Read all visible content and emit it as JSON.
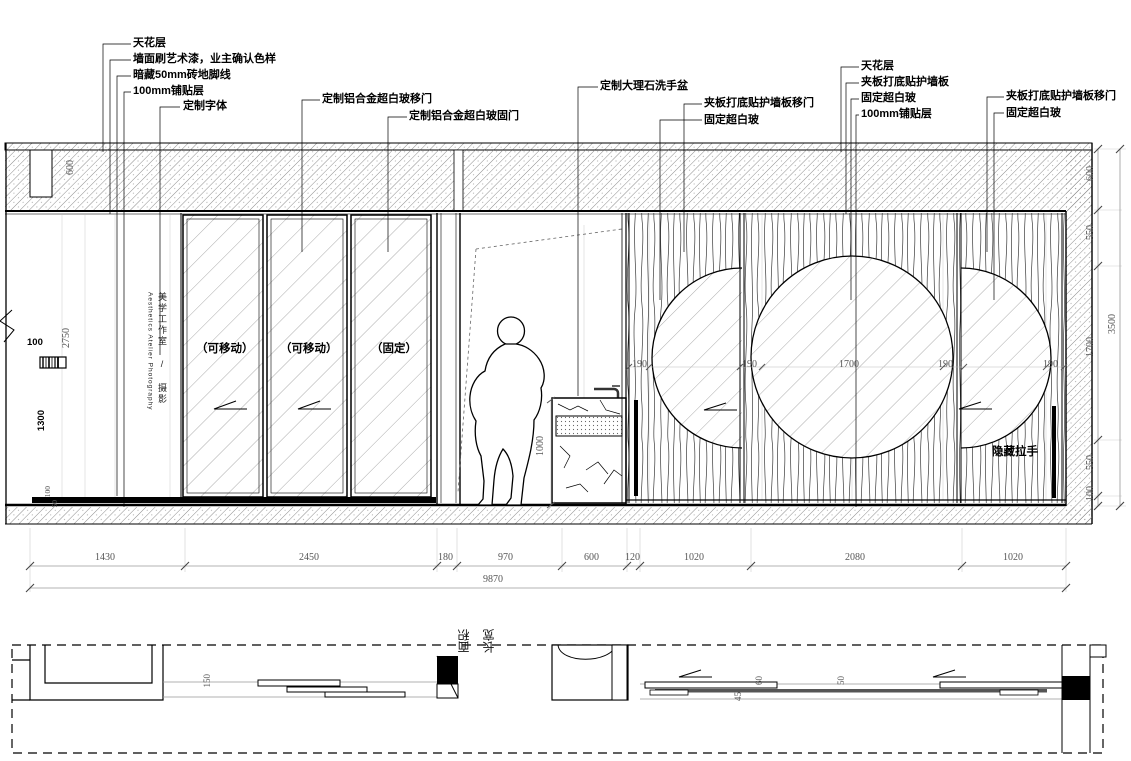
{
  "annotations": [
    "天花层",
    "墙面刷艺术漆，业主确认色样",
    "暗藏50mm砖地脚线",
    "100mm铺贴层",
    "定制字体",
    "定制铝合金超白玻移门",
    "定制铝合金超白玻固门",
    "定制大理石洗手盆",
    "夹板打底贴护墙板移门",
    "固定超白玻",
    "天花层",
    "夹板打底贴护墙板",
    "固定超白玻",
    "100mm铺贴层",
    "夹板打底贴护墙板移门",
    "固定超白玻"
  ],
  "door_labels": [
    "（可移动）",
    "（可移动）",
    "（固定）"
  ],
  "handle_label": "隐藏拉手",
  "studio": {
    "cjk": "美学工作室 / 摄影",
    "en": "Aesthetics Atelier Photography"
  },
  "dims": {
    "bottom": [
      "1430",
      "2450",
      "180",
      "970",
      "600",
      "120",
      "1020",
      "2080",
      "1020"
    ],
    "bottom_total": "9870",
    "right": [
      "600",
      "550",
      "1700",
      "550",
      "100"
    ],
    "right_total": "3500",
    "wood": [
      "190",
      "190",
      "1700",
      "190",
      "190"
    ],
    "ceiling": "600",
    "basin_height": "1000",
    "left_top": "100",
    "left_height": "2750",
    "left_mid": "1300",
    "left_floor_a": "100",
    "left_floor_b": "50",
    "plan": [
      "150",
      "45",
      "60",
      "50"
    ],
    "plan_labels": [
      "面积",
      "长宽"
    ]
  },
  "colors": {
    "line": "#000000",
    "dim_text": "#555555",
    "hatch": "#7a7a7a"
  }
}
